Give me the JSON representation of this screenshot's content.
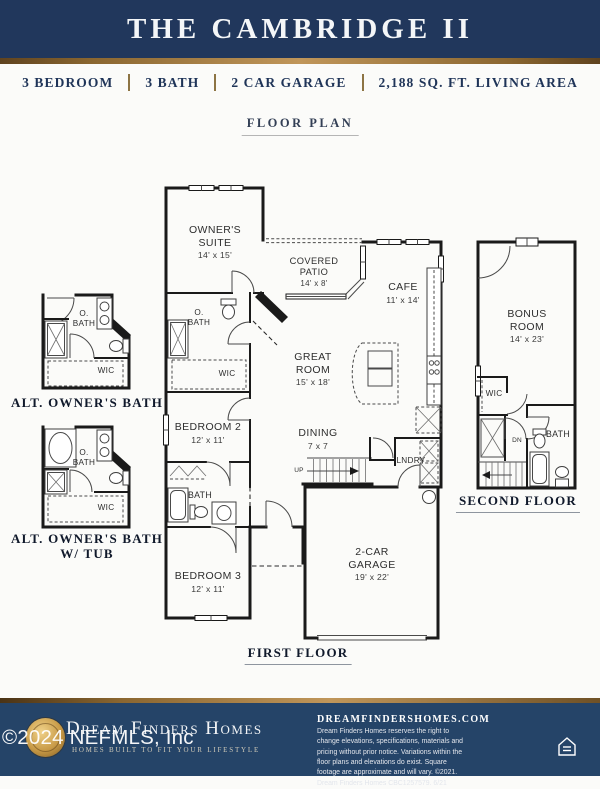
{
  "header": {
    "title": "THE CAMBRIDGE II"
  },
  "specs": {
    "bedrooms": "3 BEDROOM",
    "baths": "3 BATH",
    "garage": "2 CAR GARAGE",
    "living_area": "2,188 SQ. FT. LIVING AREA"
  },
  "floor_plan_heading": "FLOOR PLAN",
  "first_floor": {
    "label": "FIRST FLOOR",
    "owners_suite": {
      "name": "OWNER'S SUITE",
      "dims": "14' x 15'"
    },
    "covered_patio": {
      "name": "COVERED PATIO",
      "dims": "14' x 8'"
    },
    "cafe": {
      "name": "CAFE",
      "dims": "11' x 14'"
    },
    "great_room": {
      "name": "GREAT ROOM",
      "dims": "15' x 18'"
    },
    "dining": {
      "name": "DINING",
      "dims": "7 x 7"
    },
    "bedroom_2": {
      "name": "BEDROOM 2",
      "dims": "12' x 11'"
    },
    "bedroom_3": {
      "name": "BEDROOM 3",
      "dims": "12' x 11'"
    },
    "garage": {
      "name": "2-CAR GARAGE",
      "dims": "19' x 22'"
    },
    "owners_bath": "O. BATH",
    "bath": "BATH",
    "wic": "WIC",
    "laundry": "LNDRY",
    "stairs_up": "UP"
  },
  "second_floor": {
    "label": "SECOND FLOOR",
    "bonus_room": {
      "name": "BONUS ROOM",
      "dims": "14' x 23'"
    },
    "wic": "WIC",
    "bath": "BATH",
    "stairs_down": "DN"
  },
  "alt_owners_bath": {
    "label": "ALT. OWNER'S BATH",
    "owners_bath": "O. BATH",
    "wic": "WIC"
  },
  "alt_owners_bath_tub": {
    "label_line1": "ALT. OWNER'S BATH",
    "label_line2": "W/ TUB",
    "owners_bath": "O. BATH",
    "wic": "WIC"
  },
  "watermark": "©2024 NEFMLS, Inc",
  "footer": {
    "brand": "Dream Finders Homes",
    "tagline": "HOMES BUILT TO FIT YOUR LIFESTYLE",
    "website": "DREAMFINDERSHOMES.COM",
    "disclaimer": "Dream Finders Homes reserves the right to change elevations, specifications, materials and pricing without prior notice. Variations within the floor plans and elevations do exist. Square footage are approximate and will vary. ©2021. Dream Finders Homes CBC1257579. 6/21"
  },
  "colors": {
    "header_navy": "#21375c",
    "footer_navy": "#254468",
    "gold": "#c0965a",
    "wall": "#1a1a1a"
  }
}
